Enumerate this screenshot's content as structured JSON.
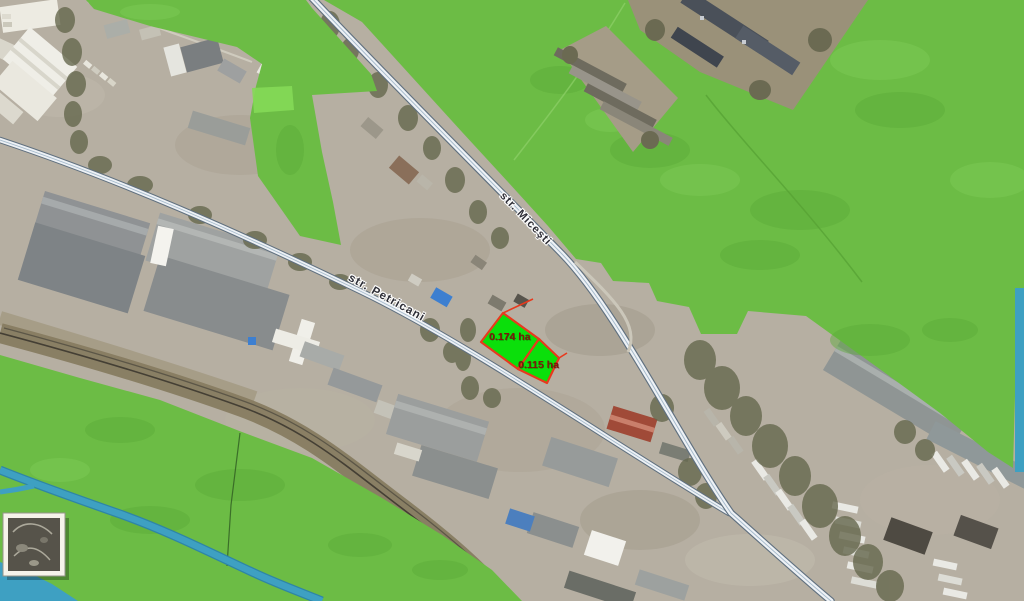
{
  "map": {
    "streets": [
      {
        "name": "str. Miceşti"
      },
      {
        "name": "str. Petricani"
      }
    ],
    "parcels": [
      {
        "area_label": "0.174 ha"
      },
      {
        "area_label": "0.115 ha"
      }
    ],
    "inset": {
      "icon": "overview-thumbnail-icon"
    }
  },
  "colors": {
    "zone-green": "#6CBC45",
    "zone-green-light": "#85D957",
    "parcel-green": "#0BDF0B",
    "parcel-red": "#E8391D",
    "parcel-label-red": "#7E180B",
    "water-blue": "#3EA0C2",
    "water-deep": "#2E85A6",
    "road-fill": "#EDF1F5",
    "road-casing": "#60707F",
    "street-label": "#2E2E36",
    "photo-ground": "#B6AFA2"
  }
}
